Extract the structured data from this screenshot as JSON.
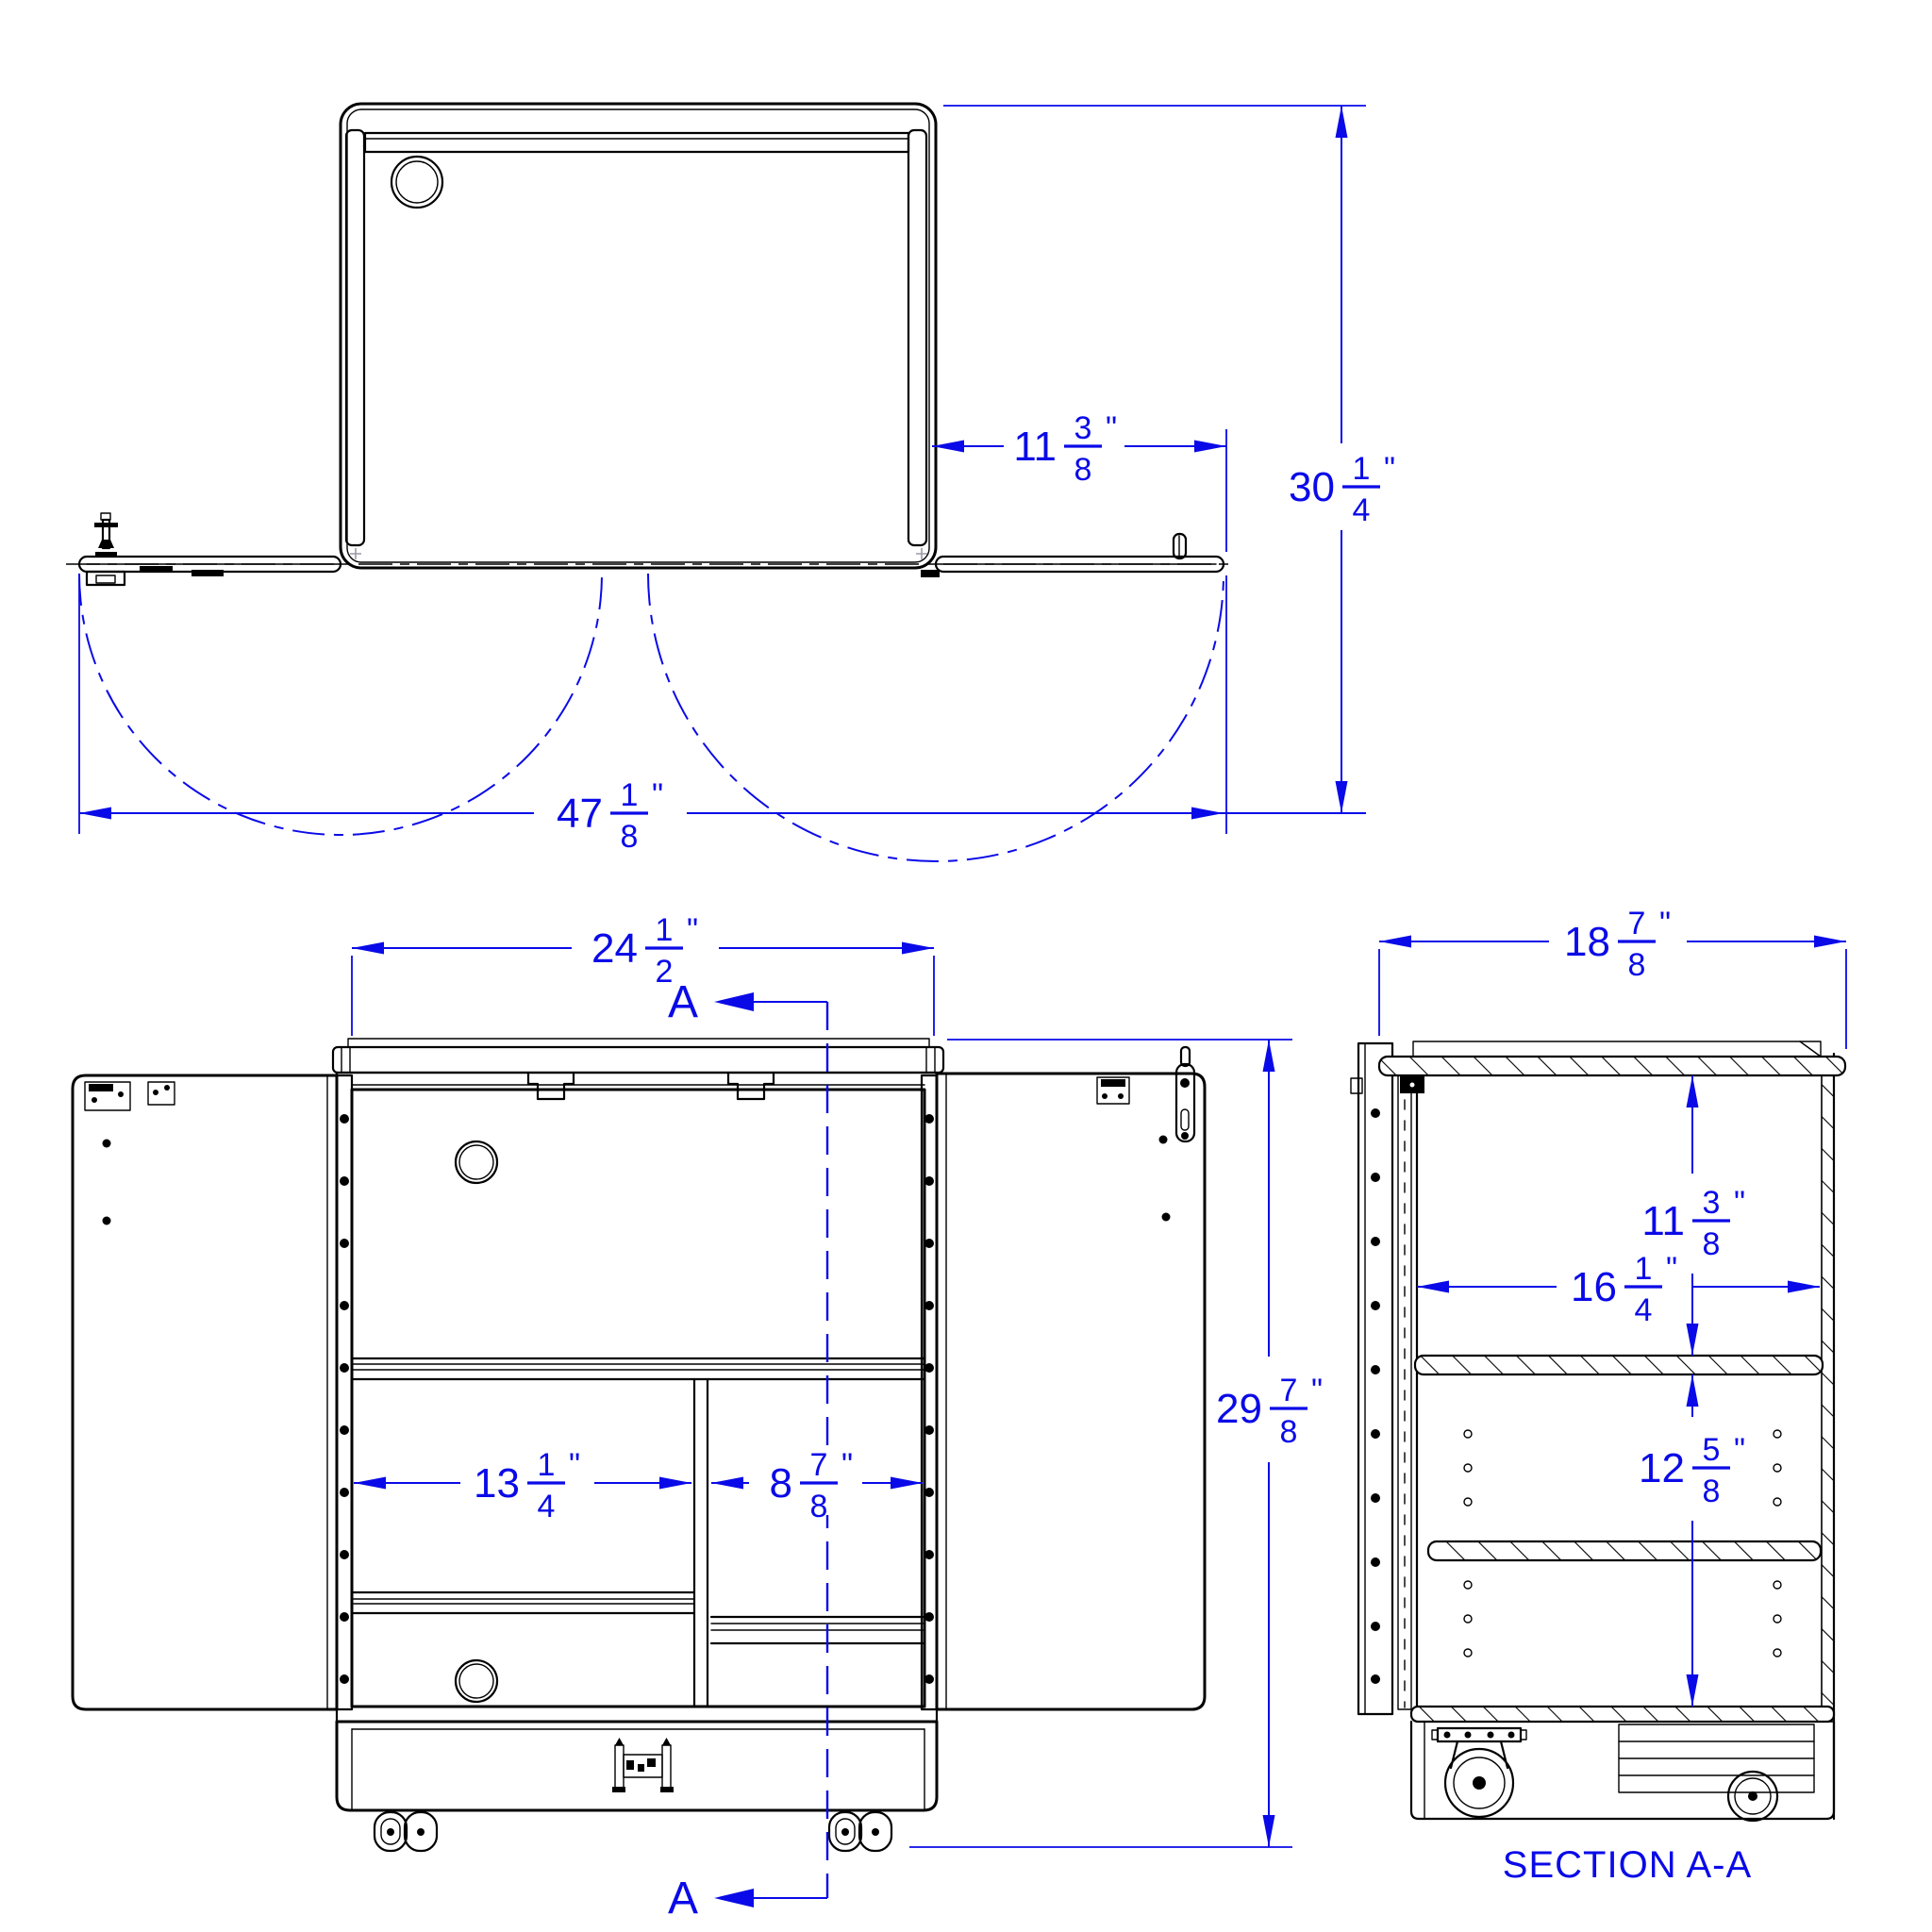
{
  "colors": {
    "dimension_blue": "#0a0ae8",
    "linework_black": "#000000",
    "background": "#ffffff"
  },
  "section": {
    "label": "SECTION A-A",
    "cut_letter": "A"
  },
  "dimensions": {
    "door_open_width": {
      "whole": "11",
      "num": "3",
      "den": "8",
      "unit": "\""
    },
    "overall_depth_doors_open": {
      "whole": "30",
      "num": "1",
      "den": "4",
      "unit": "\""
    },
    "overall_width_doors_open": {
      "whole": "47",
      "num": "1",
      "den": "8",
      "unit": "\""
    },
    "cabinet_width": {
      "whole": "24",
      "num": "1",
      "den": "2",
      "unit": "\""
    },
    "cabinet_height": {
      "whole": "29",
      "num": "7",
      "den": "8",
      "unit": "\""
    },
    "left_compartment_width": {
      "whole": "13",
      "num": "1",
      "den": "4",
      "unit": "\""
    },
    "right_compartment_width": {
      "whole": "8",
      "num": "7",
      "den": "8",
      "unit": "\""
    },
    "cabinet_depth": {
      "whole": "18",
      "num": "7",
      "den": "8",
      "unit": "\""
    },
    "upper_compartment_height": {
      "whole": "11",
      "num": "3",
      "den": "8",
      "unit": "\""
    },
    "interior_depth": {
      "whole": "16",
      "num": "1",
      "den": "4",
      "unit": "\""
    },
    "lower_compartment_height": {
      "whole": "12",
      "num": "5",
      "den": "8",
      "unit": "\""
    }
  }
}
